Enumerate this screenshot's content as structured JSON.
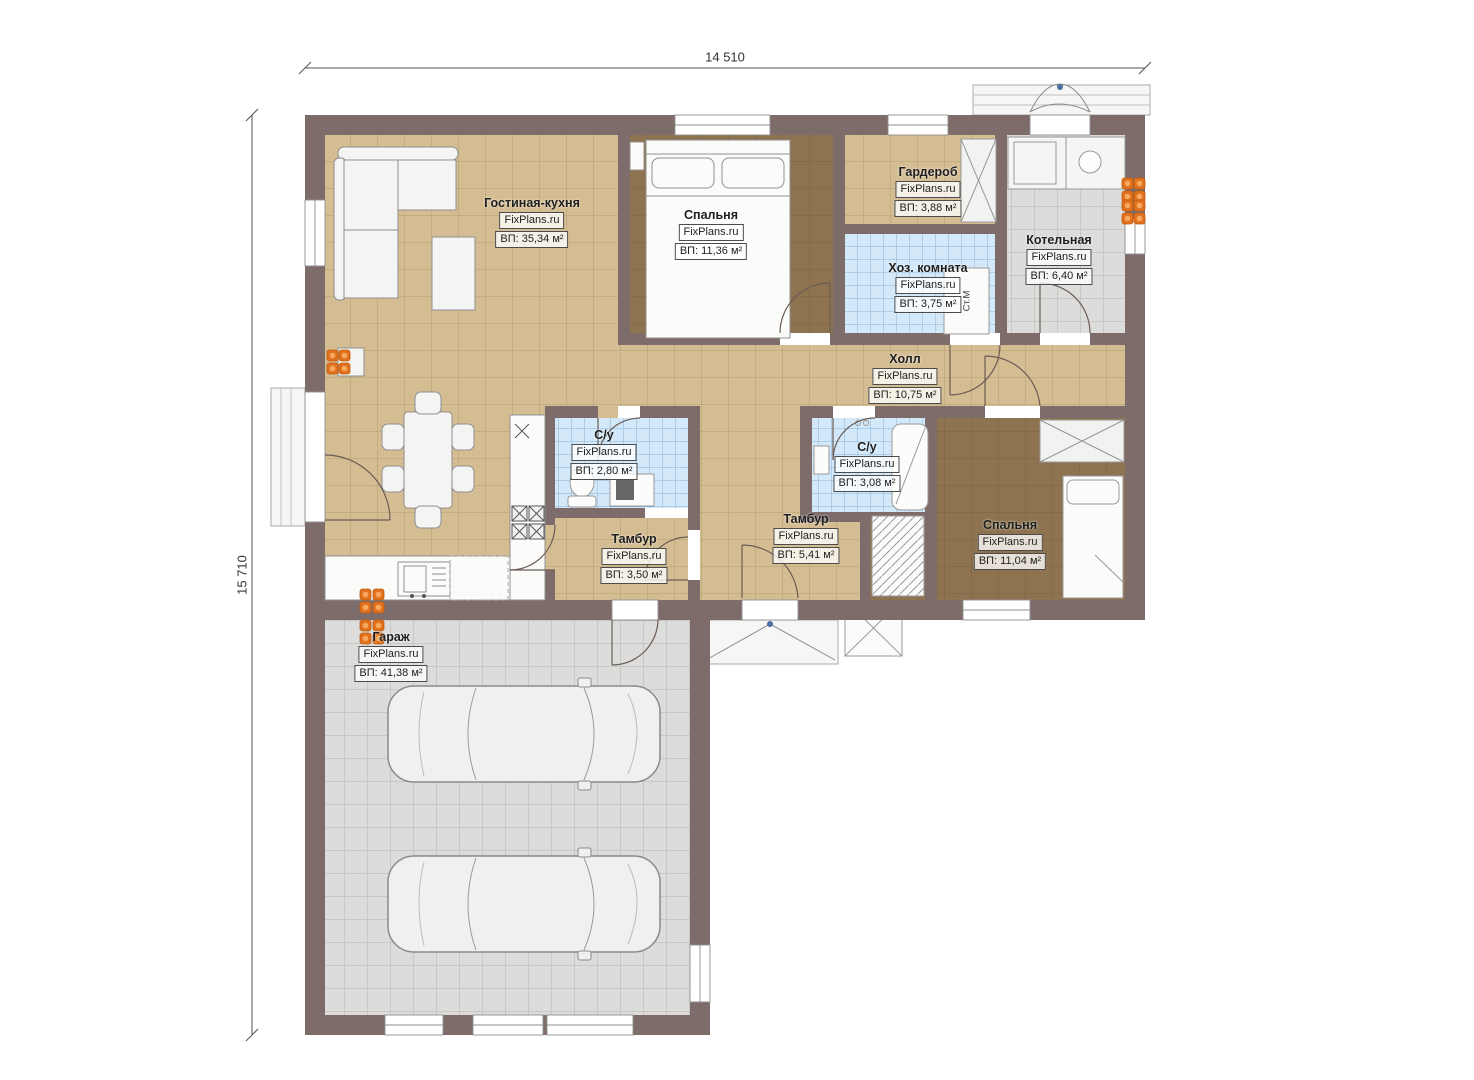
{
  "dimensions": {
    "width_mm": "14 510",
    "height_mm": "15 710"
  },
  "rooms": [
    {
      "name": "Гостиная-кухня",
      "brand": "FixPlans.ru",
      "area": "ВП: 35,34 м²"
    },
    {
      "name": "Спальня",
      "brand": "FixPlans.ru",
      "area": "ВП: 11,36 м²"
    },
    {
      "name": "Гардероб",
      "brand": "FixPlans.ru",
      "area": "ВП: 3,88 м²"
    },
    {
      "name": "Хоз. комната",
      "brand": "FixPlans.ru",
      "area": "ВП: 3,75 м²"
    },
    {
      "name": "Котельная",
      "brand": "FixPlans.ru",
      "area": "ВП: 6,40 м²"
    },
    {
      "name": "Холл",
      "brand": "FixPlans.ru",
      "area": "ВП: 10,75 м²"
    },
    {
      "name": "С/у",
      "brand": "FixPlans.ru",
      "area": "ВП: 2,80 м²"
    },
    {
      "name": "С/у",
      "brand": "FixPlans.ru",
      "area": "ВП: 3,08 м²"
    },
    {
      "name": "Тамбур",
      "brand": "FixPlans.ru",
      "area": "ВП: 5,41 м²"
    },
    {
      "name": "Тамбур",
      "brand": "FixPlans.ru",
      "area": "ВП: 3,50 м²"
    },
    {
      "name": "Спальня",
      "brand": "FixPlans.ru",
      "area": "ВП: 11,04 м²"
    },
    {
      "name": "Гараж",
      "brand": "FixPlans.ru",
      "area": "ВП: 41,38 м²"
    }
  ],
  "annotations": {
    "washing_machine": "Ст.М"
  },
  "colors": {
    "wall": "#7e6c6a",
    "floor_tan": "#d5bd93",
    "floor_brown": "#8d7350",
    "floor_blue": "#d3e9f9",
    "floor_gray": "#dcdcdb",
    "radiator": "#e2711d"
  }
}
